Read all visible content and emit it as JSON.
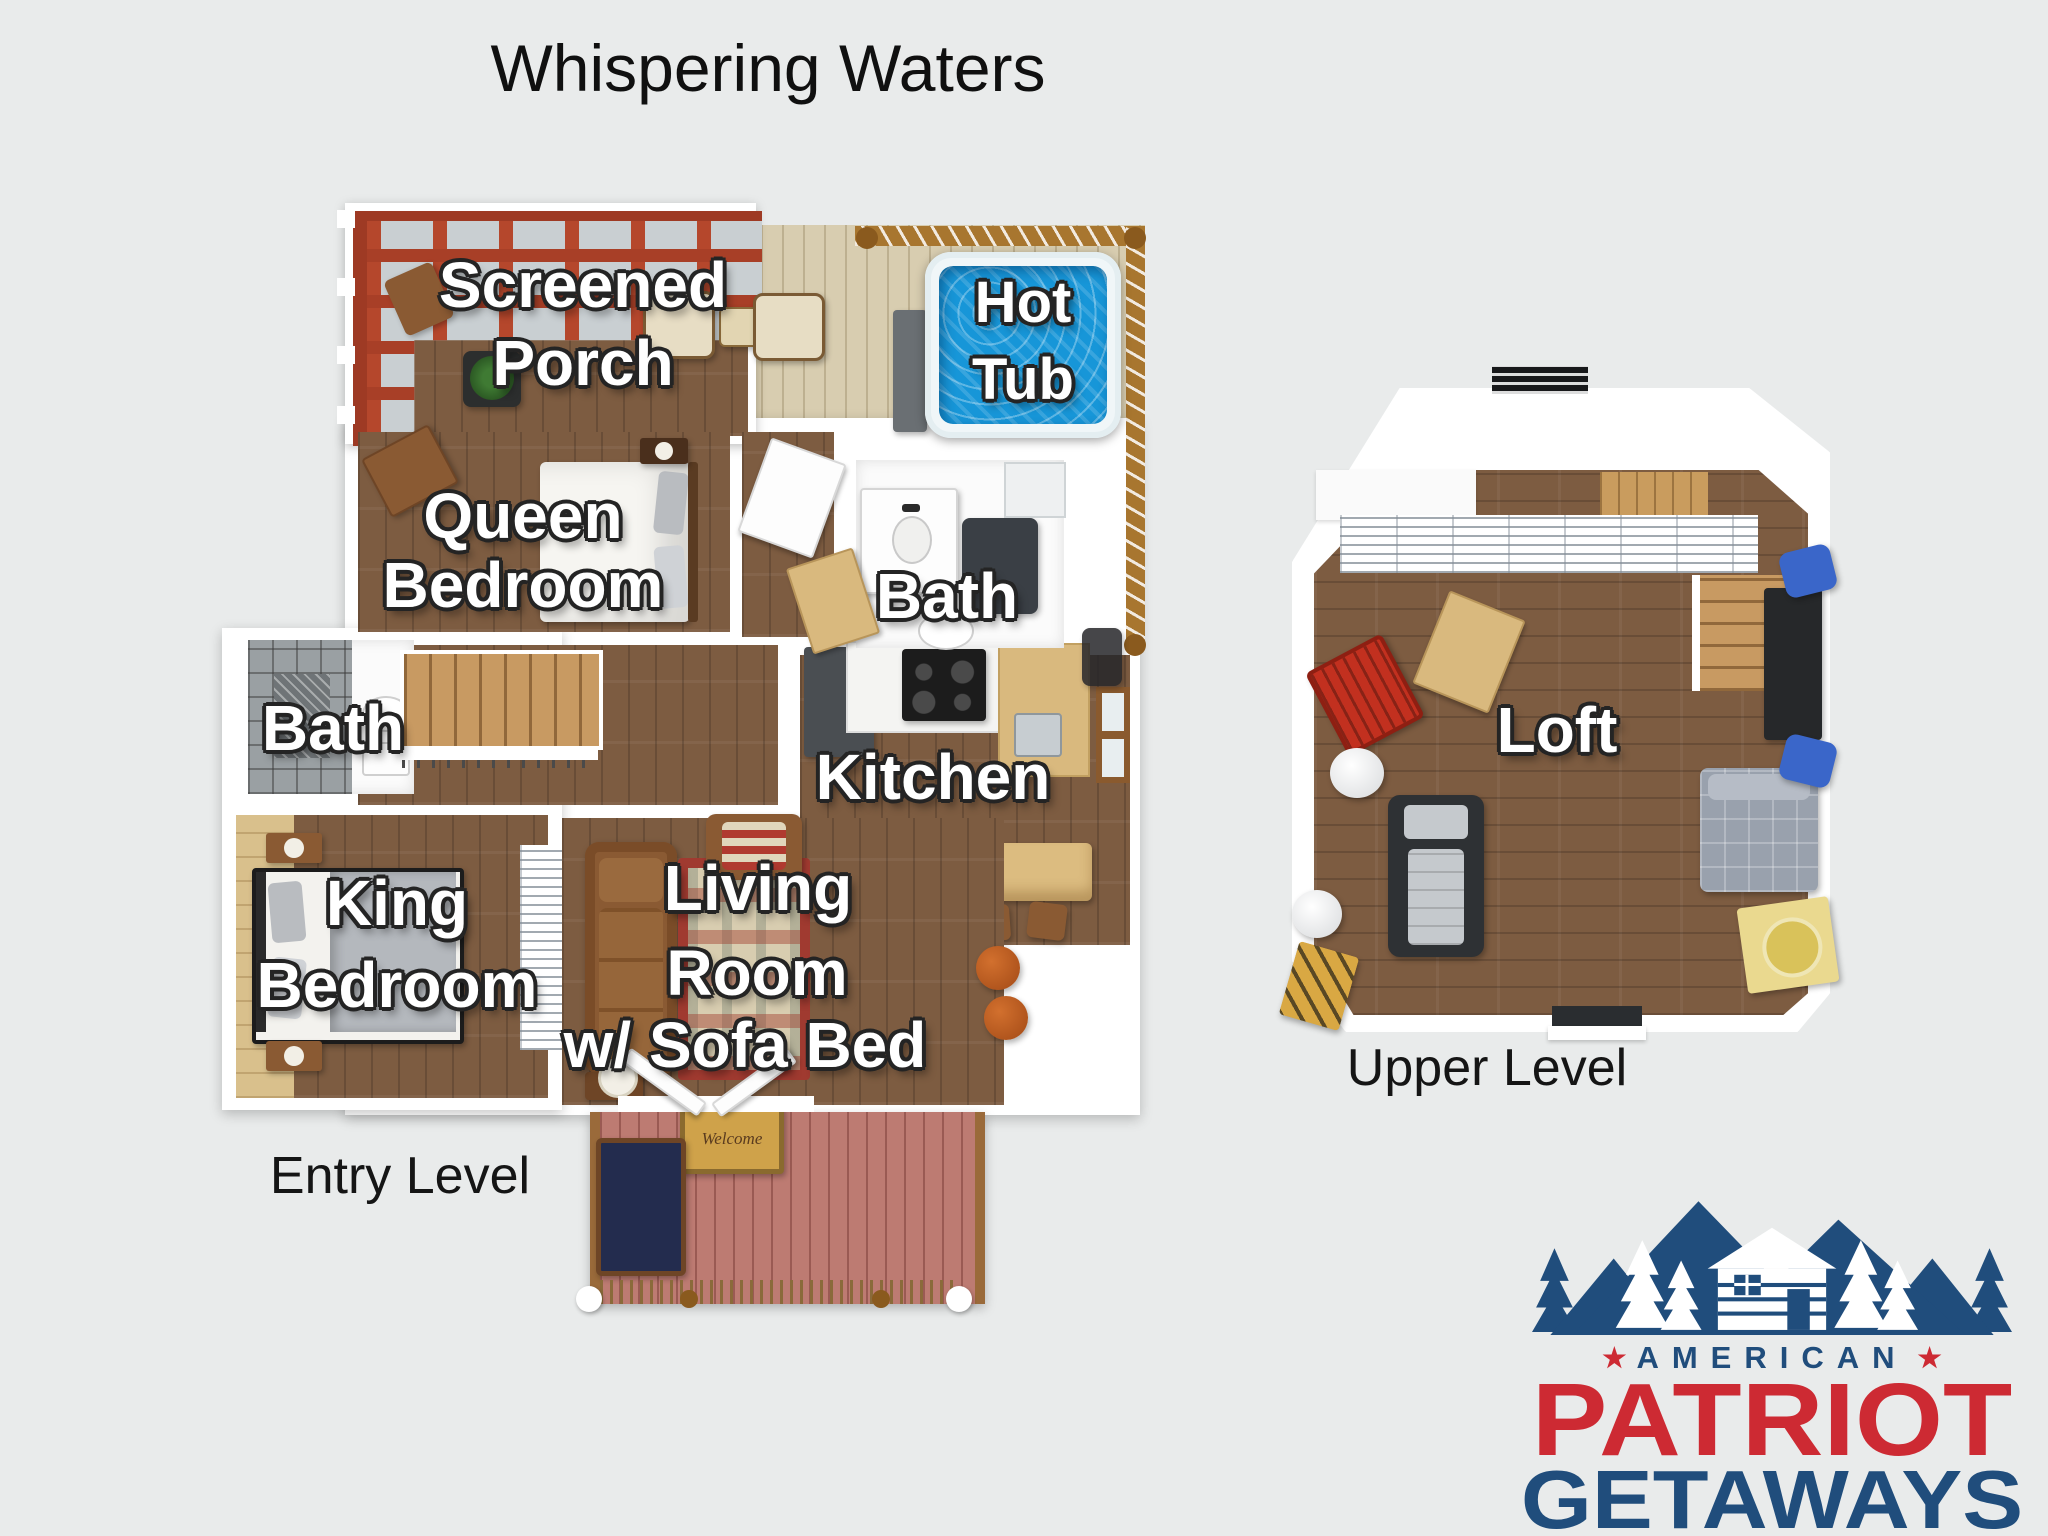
{
  "page": {
    "title": "Whispering Waters"
  },
  "entry_level": {
    "caption": "Entry Level",
    "labels": {
      "screened_porch_1": "Screened",
      "screened_porch_2": "Porch",
      "hot_tub_1": "Hot",
      "hot_tub_2": "Tub",
      "queen_1": "Queen",
      "queen_2": "Bedroom",
      "bath_right": "Bath",
      "bath_left": "Bath",
      "kitchen": "Kitchen",
      "king_1": "King",
      "king_2": "Bedroom",
      "living_1": "Living",
      "living_2": "Room",
      "living_3": "w/ Sofa Bed"
    },
    "welcome_mat": "Welcome"
  },
  "upper_level": {
    "caption": "Upper Level",
    "labels": {
      "loft": "Loft"
    }
  },
  "logo": {
    "american": "AMERICAN",
    "patriot": "PATRIOT",
    "getaways": "GETAWAYS",
    "star": "★",
    "blue": "#204d7c",
    "red": "#cd2a33"
  },
  "colors": {
    "background": "#e9ebeb",
    "porch_pergola_red": "#b5472c",
    "hot_tub_blue": "#1796d8",
    "deck_tan": "#d8cdb0",
    "front_deck_red": "#bd7b72",
    "wood_floor": "#7d5c41",
    "wall_white": "#ffffff"
  }
}
